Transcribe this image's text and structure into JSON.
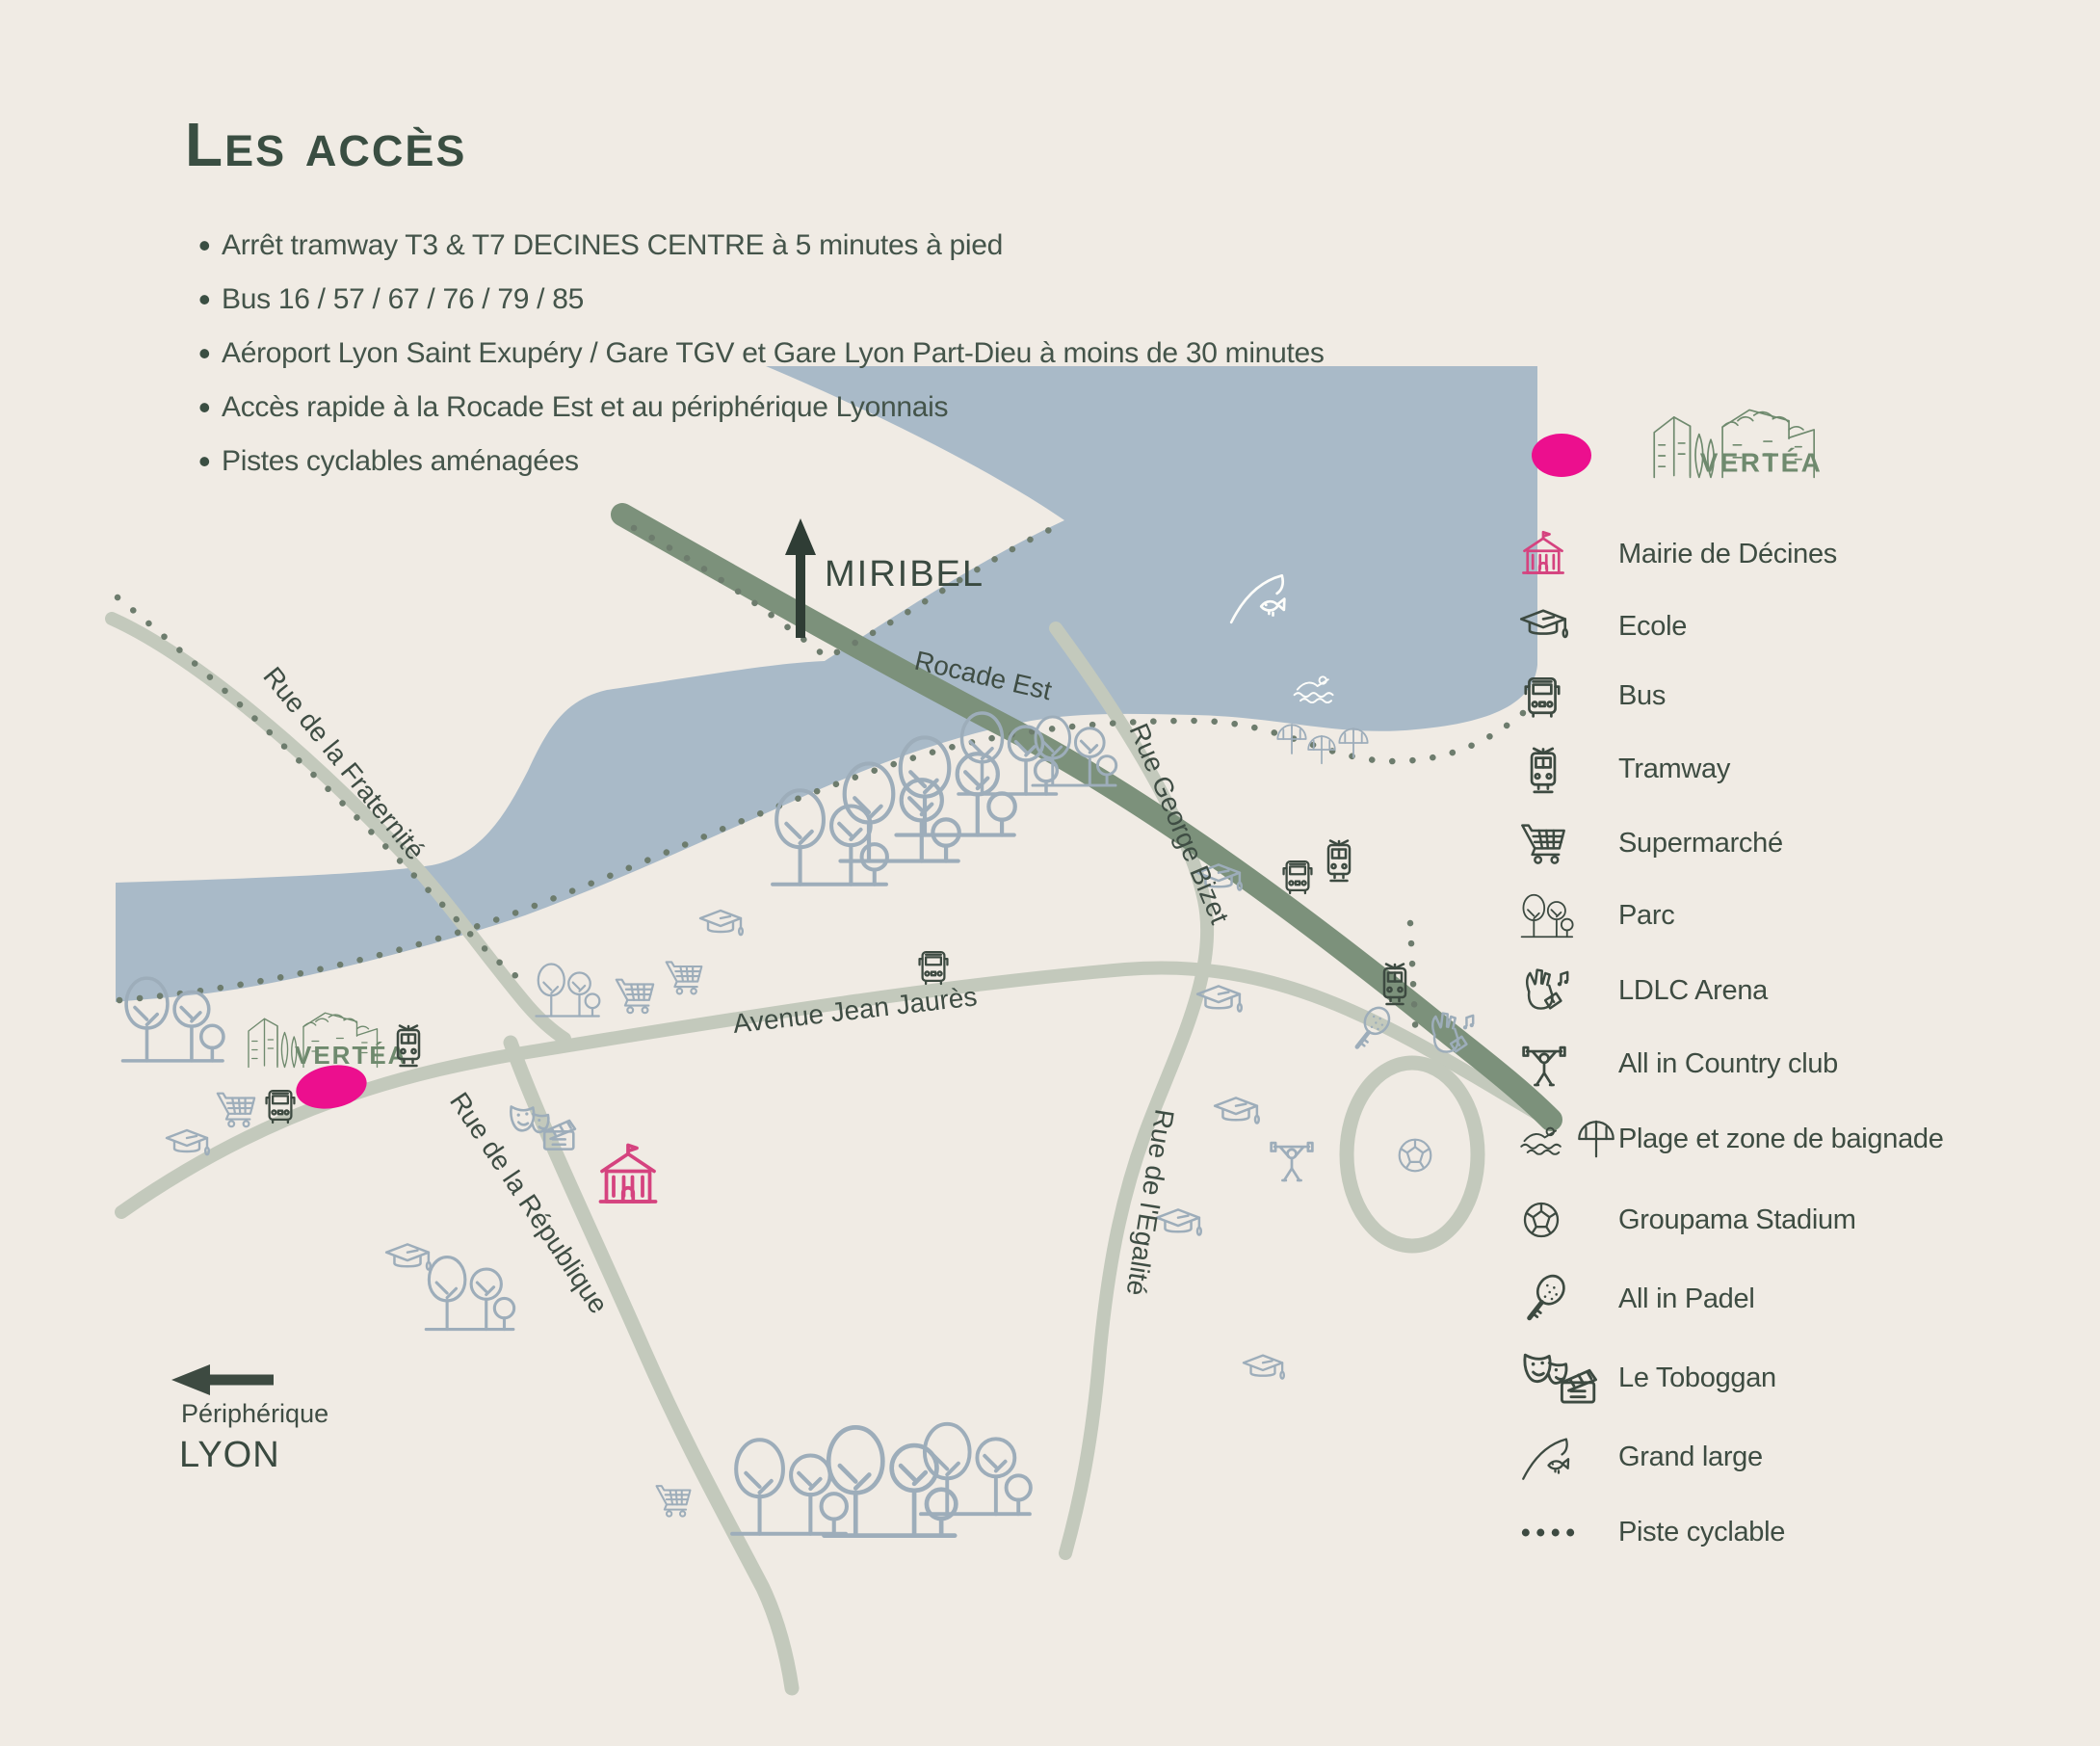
{
  "header": {
    "title": "Les accès",
    "bullets": [
      "Arrêt tramway T3 & T7 DECINES CENTRE à 5 minutes à pied",
      "Bus 16 / 57 / 67 / 76 / 79 / 85",
      "Aéroport Lyon Saint Exupéry / Gare TGV et Gare Lyon Part-Dieu à moins de 30 minutes",
      "Accès rapide à la Rocade Est et au périphérique Lyonnais",
      "Pistes cyclables aménagées"
    ]
  },
  "legend": {
    "logo_text": "VERTÉA",
    "items": [
      {
        "icon": "mairie-icon",
        "label": "Mairie de Décines"
      },
      {
        "icon": "graduation-cap-icon",
        "label": "Ecole"
      },
      {
        "icon": "bus-icon",
        "label": "Bus"
      },
      {
        "icon": "tramway-icon",
        "label": "Tramway"
      },
      {
        "icon": "shopping-cart-icon",
        "label": "Supermarché"
      },
      {
        "icon": "trees-icon",
        "label": "Parc"
      },
      {
        "icon": "rock-hand-icon",
        "label": "LDLC Arena"
      },
      {
        "icon": "weightlifter-icon",
        "label": "All in Country club"
      },
      {
        "icon": "swimmer-umbrella-icon",
        "label": "Plage et zone de baignade"
      },
      {
        "icon": "soccer-ball-icon",
        "label": "Groupama Stadium"
      },
      {
        "icon": "padel-racket-icon",
        "label": "All in Padel"
      },
      {
        "icon": "masks-clapper-icon",
        "label": "Le Toboggan"
      },
      {
        "icon": "fishing-icon",
        "label": "Grand large"
      },
      {
        "icon": "dotted-line-icon",
        "label": "Piste cyclable"
      }
    ]
  },
  "map": {
    "logo_text": "VERTÉA",
    "labels": {
      "miribel": "MIRIBEL",
      "rocade": "Rocade Est",
      "fraternite": "Rue de la Fraternité",
      "jaures": "Avenue Jean Jaurès",
      "bizet": "Rue George Bizet",
      "egalite": "Rue de l'Egalité",
      "republique": "Rue de la République",
      "peripherique": "Périphérique",
      "lyon": "LYON"
    },
    "colors": {
      "background": "#f0ebe4",
      "river": "#a9bac8",
      "road_light": "#c3c9bc",
      "rocade_green": "#7c917b",
      "ink_dark": "#3d4a41",
      "icon_light": "#9dadba",
      "icon_white": "#fdfdfa",
      "pink": "#ec0f8e",
      "mairie_pink": "#d5437f",
      "logo_green": "#6f8a6e",
      "dots": "#6d7c6d"
    }
  }
}
